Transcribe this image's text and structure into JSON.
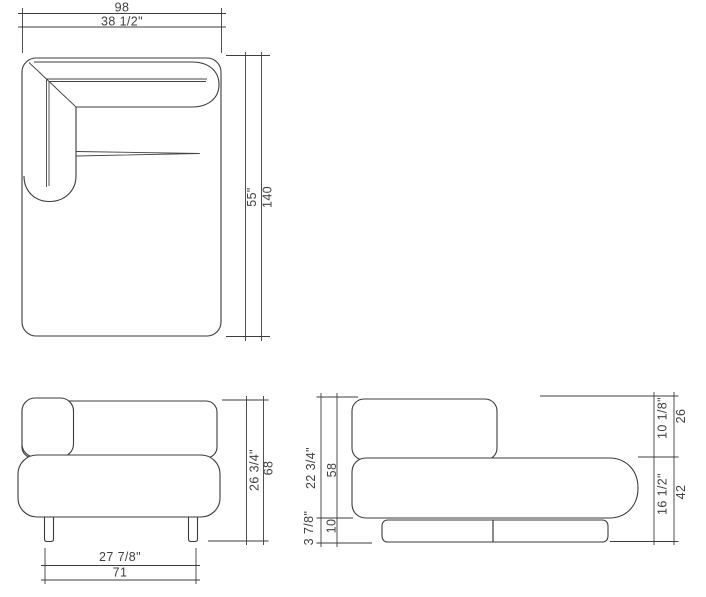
{
  "title": "Sofa module technical drawing, three orthographic views with dual-unit dimensions",
  "colors": {
    "background": "#ffffff",
    "line": "#3b3b3b",
    "text": "#3f3f3f"
  },
  "views": {
    "top": {
      "label": "plan view",
      "width_cm": "98",
      "width_in": "38 1/2\"",
      "depth_in": "55\"",
      "depth_cm": "140"
    },
    "front": {
      "label": "front view",
      "height_in": "26 3/4\"",
      "height_cm": "68",
      "leg_span_in": "27 7/8\"",
      "leg_span_cm": "71"
    },
    "side": {
      "label": "side view",
      "body_height_in": "22 3/4\"",
      "body_height_cm": "58",
      "base_height_in": "3 7/8\"",
      "base_height_cm": "10",
      "backrest_height_in": "10 1/8\"",
      "backrest_height_cm": "26",
      "seat_height_in": "16 1/2\"",
      "seat_height_cm": "42"
    }
  }
}
